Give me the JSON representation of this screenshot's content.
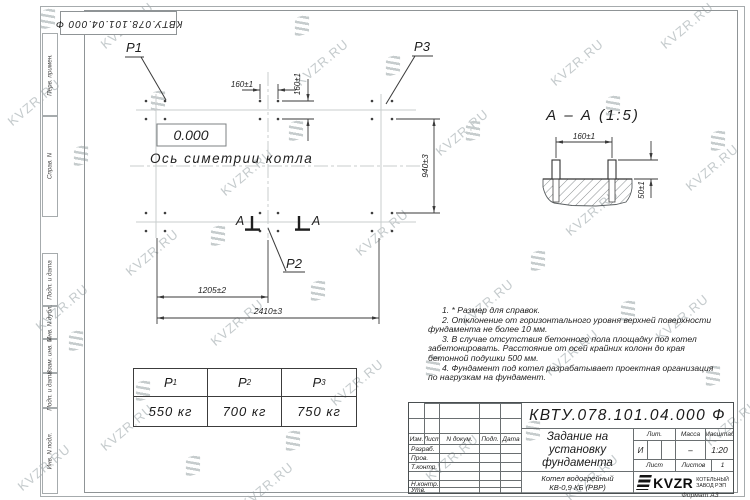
{
  "watermark": {
    "text": "KVZR.RU"
  },
  "stamp_top": "КВТУ.078.101.04.000 Ф",
  "side_strip": {
    "items": [
      "Перв. примен.",
      "Справ. N",
      "Подп. и дата",
      "Инв. N дубл.",
      "Взам. инв. N",
      "Подп. и дата",
      "Инв. N подл."
    ]
  },
  "plan": {
    "elevation": "0.000",
    "axis_label": "Ось симетрии котла",
    "points": {
      "p1": "P1",
      "p2": "P2",
      "p3": "P3"
    },
    "dims": {
      "d160_top": "160±1",
      "d160_side": "160±1",
      "d940": "940±3",
      "d1205": "1205±2",
      "d2410": "2410±3"
    },
    "section_letter_left": "А",
    "section_letter_right": "А"
  },
  "section": {
    "title": "А – А (1:5)",
    "d160": "160±1",
    "d50": "50±1"
  },
  "notes": {
    "items": [
      "1. * Размер для справок.",
      "2. Отклонение от горизонтального уровня верхней поверхности фундамента не более 10 мм.",
      "3. В случае отсутствия бетонного пола площадку под котел забетонировать. Расстояние от осей крайних колонн до края бетонной подушки 500 мм.",
      "4. Фундамент под котел разрабатывает проектная организация по нагрузкам на фундамент."
    ]
  },
  "load_table": {
    "cols": [
      {
        "p": "P",
        "sub": "1",
        "value": "550 кг"
      },
      {
        "p": "P",
        "sub": "2",
        "value": "700 кг"
      },
      {
        "p": "P",
        "sub": "3",
        "value": "750 кг"
      }
    ]
  },
  "title_block": {
    "doc_number": "КВТУ.078.101.04.000 Ф",
    "title": "Задание на установку фундамента",
    "product_line1": "Котел водогрейный",
    "product_line2": "КВ-0,9 КБ (РВР)",
    "headers": {
      "izm": "Изм.",
      "list": "Лист",
      "doc": "N докум.",
      "podp": "Подп.",
      "data": "Дата",
      "lit": "Лит.",
      "massa": "Масса",
      "masshtab": "Масштаб",
      "sheet": "Лист",
      "sheets": "Листов"
    },
    "rows": {
      "r1": "Разраб.",
      "r2": "Пров.",
      "r3": "Т.контр.",
      "r4": "",
      "r5": "Н.контр.",
      "r6": "Утв."
    },
    "values": {
      "lit": "И",
      "massa": "–",
      "scale": "1:20",
      "sheets_count": "1"
    },
    "logo": {
      "text": "KVZR",
      "caption1": "КОТЕЛЬНЫЙ",
      "caption2": "ЗАВОД РЭП"
    },
    "format": "Формат А3"
  }
}
